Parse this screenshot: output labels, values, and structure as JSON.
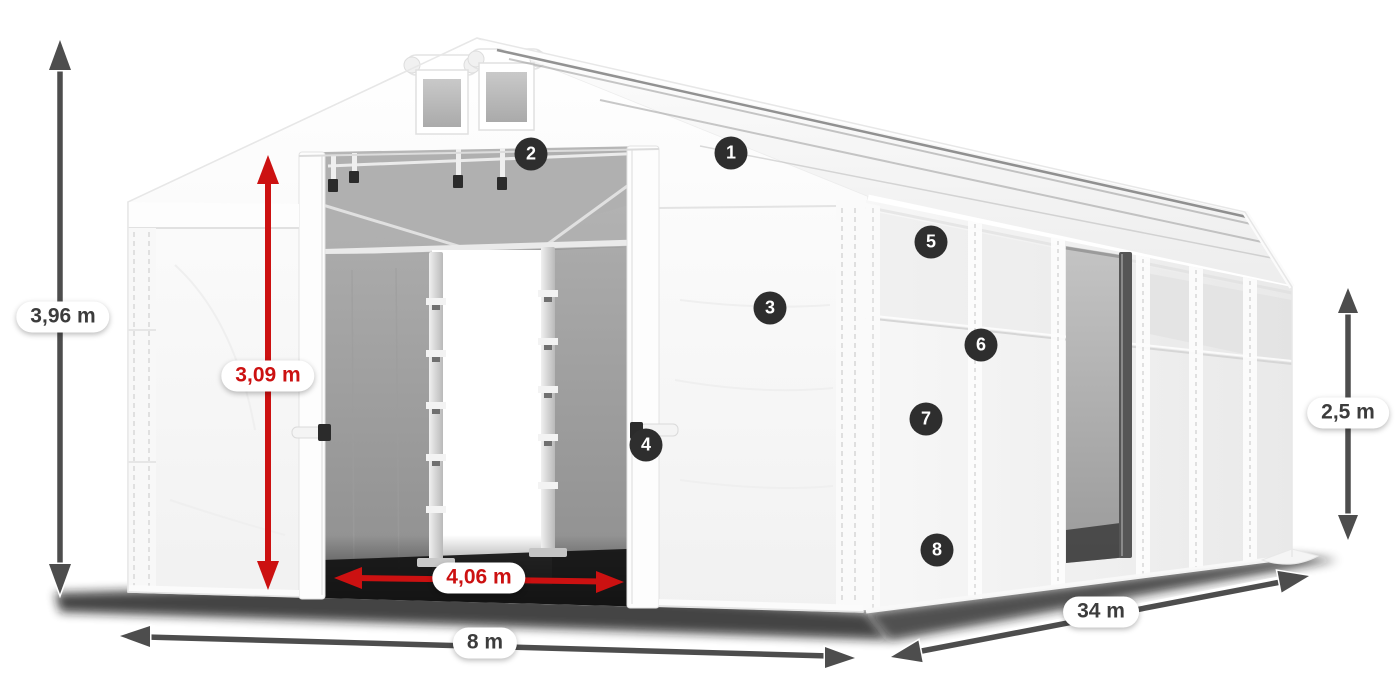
{
  "product": {
    "dimensions": {
      "total_height": "3,96 m",
      "door_height": "3,09 m",
      "door_width": "4,06 m",
      "front_width": "8 m",
      "length": "34 m",
      "side_wall_height": "2,5 m"
    },
    "callouts": [
      {
        "label": "1"
      },
      {
        "label": "2"
      },
      {
        "label": "3"
      },
      {
        "label": "4"
      },
      {
        "label": "5"
      },
      {
        "label": "6"
      },
      {
        "label": "7"
      },
      {
        "label": "8"
      }
    ],
    "colors": {
      "accent_red": "#cc1111",
      "dimension_arrow_gray": "#4d4d4d",
      "label_text_gray": "#3c3c3c",
      "badge_background": "#2e2e2e",
      "tent_fabric_white": "#f5f5f5",
      "interior_gray": "#9a9a9a"
    }
  }
}
